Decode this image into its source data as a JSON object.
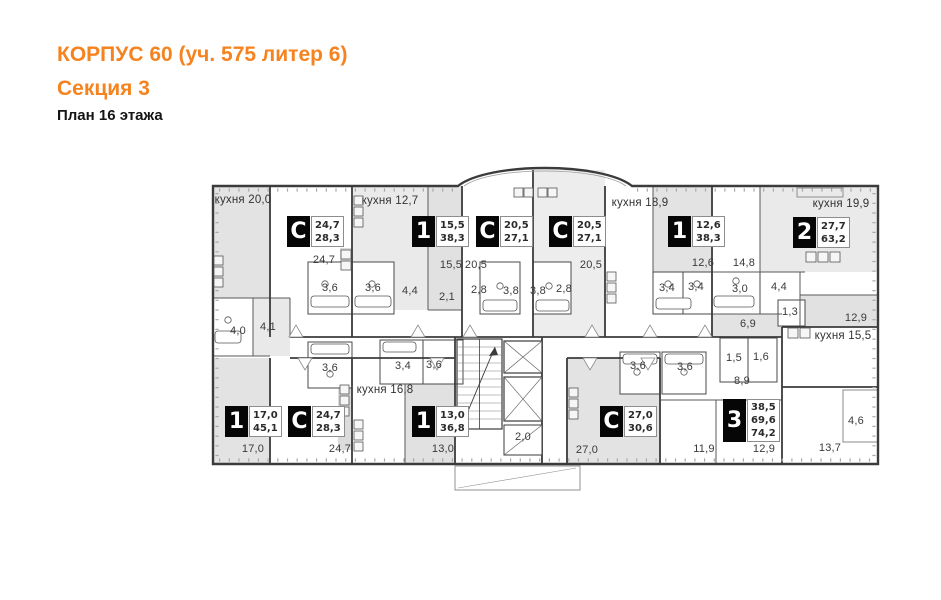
{
  "header": {
    "title": "КОРПУС 60 (уч. 575 литер 6)",
    "subtitle": "Секция 3",
    "floor_label": "План 16 этажа"
  },
  "colors": {
    "accent_orange": "#f5831f",
    "wall": "#3b3b3b",
    "room_fill_gray": "#e3e3e3",
    "badge_background": "#060606"
  },
  "plan": {
    "apartments": [
      {
        "type": "С",
        "areas": [
          "24,7",
          "28,3"
        ],
        "x": 287,
        "y": 216
      },
      {
        "type": "1",
        "areas": [
          "15,5",
          "38,3"
        ],
        "x": 412,
        "y": 216
      },
      {
        "type": "С",
        "areas": [
          "20,5",
          "27,1"
        ],
        "x": 476,
        "y": 216
      },
      {
        "type": "С",
        "areas": [
          "20,5",
          "27,1"
        ],
        "x": 549,
        "y": 216
      },
      {
        "type": "1",
        "areas": [
          "12,6",
          "38,3"
        ],
        "x": 668,
        "y": 216
      },
      {
        "type": "2",
        "areas": [
          "27,7",
          "63,2"
        ],
        "x": 793,
        "y": 217
      },
      {
        "type": "1",
        "areas": [
          "17,0",
          "45,1"
        ],
        "x": 225,
        "y": 406
      },
      {
        "type": "С",
        "areas": [
          "24,7",
          "28,3"
        ],
        "x": 288,
        "y": 406
      },
      {
        "type": "1",
        "areas": [
          "13,0",
          "36,8"
        ],
        "x": 412,
        "y": 406
      },
      {
        "type": "С",
        "areas": [
          "27,0",
          "30,6"
        ],
        "x": 600,
        "y": 406
      },
      {
        "type": "3",
        "areas": [
          "38,5",
          "69,6",
          "74,2"
        ],
        "x": 723,
        "y": 399
      }
    ],
    "kitchen_labels": [
      {
        "text": "кухня 20,0",
        "x": 243,
        "y": 200
      },
      {
        "text": "кухня 12,7",
        "x": 390,
        "y": 201
      },
      {
        "text": "кухня 18,9",
        "x": 640,
        "y": 203
      },
      {
        "text": "кухня 19,9",
        "x": 841,
        "y": 204
      },
      {
        "text": "кухня 15,5",
        "x": 843,
        "y": 336
      },
      {
        "text": "кухня 16,8",
        "x": 385,
        "y": 390
      }
    ],
    "room_labels": [
      {
        "text": "24,7",
        "x": 324,
        "y": 260
      },
      {
        "text": "3,6",
        "x": 330,
        "y": 288
      },
      {
        "text": "3,6",
        "x": 373,
        "y": 288
      },
      {
        "text": "4,4",
        "x": 410,
        "y": 291
      },
      {
        "text": "2,1",
        "x": 447,
        "y": 297
      },
      {
        "text": "15,5",
        "x": 451,
        "y": 265
      },
      {
        "text": "20,5",
        "x": 476,
        "y": 265
      },
      {
        "text": "2,8",
        "x": 479,
        "y": 290
      },
      {
        "text": "3,8",
        "x": 511,
        "y": 291
      },
      {
        "text": "3,8",
        "x": 538,
        "y": 291
      },
      {
        "text": "2,8",
        "x": 564,
        "y": 289
      },
      {
        "text": "20,5",
        "x": 591,
        "y": 265
      },
      {
        "text": "12,6",
        "x": 703,
        "y": 263
      },
      {
        "text": "3,4",
        "x": 667,
        "y": 288
      },
      {
        "text": "3,4",
        "x": 696,
        "y": 287
      },
      {
        "text": "14,8",
        "x": 744,
        "y": 263
      },
      {
        "text": "3,0",
        "x": 740,
        "y": 289
      },
      {
        "text": "4,4",
        "x": 779,
        "y": 287
      },
      {
        "text": "1,3",
        "x": 790,
        "y": 312
      },
      {
        "text": "6,9",
        "x": 748,
        "y": 324
      },
      {
        "text": "12,9",
        "x": 856,
        "y": 318
      },
      {
        "text": "4,0",
        "x": 238,
        "y": 331
      },
      {
        "text": "4,1",
        "x": 268,
        "y": 327
      },
      {
        "text": "3,6",
        "x": 330,
        "y": 368
      },
      {
        "text": "3,4",
        "x": 403,
        "y": 366
      },
      {
        "text": "3,6",
        "x": 434,
        "y": 365
      },
      {
        "text": "17,0",
        "x": 253,
        "y": 449
      },
      {
        "text": "24,7",
        "x": 340,
        "y": 449
      },
      {
        "text": "13,0",
        "x": 443,
        "y": 449
      },
      {
        "text": "2,0",
        "x": 523,
        "y": 437
      },
      {
        "text": "27,0",
        "x": 587,
        "y": 450
      },
      {
        "text": "3,6",
        "x": 638,
        "y": 366
      },
      {
        "text": "3,6",
        "x": 685,
        "y": 367
      },
      {
        "text": "1,5",
        "x": 734,
        "y": 358
      },
      {
        "text": "1,6",
        "x": 761,
        "y": 357
      },
      {
        "text": "8,9",
        "x": 742,
        "y": 381
      },
      {
        "text": "11,9",
        "x": 704,
        "y": 449
      },
      {
        "text": "12,9",
        "x": 764,
        "y": 449
      },
      {
        "text": "13,7",
        "x": 830,
        "y": 448
      },
      {
        "text": "4,6",
        "x": 856,
        "y": 421
      }
    ]
  }
}
